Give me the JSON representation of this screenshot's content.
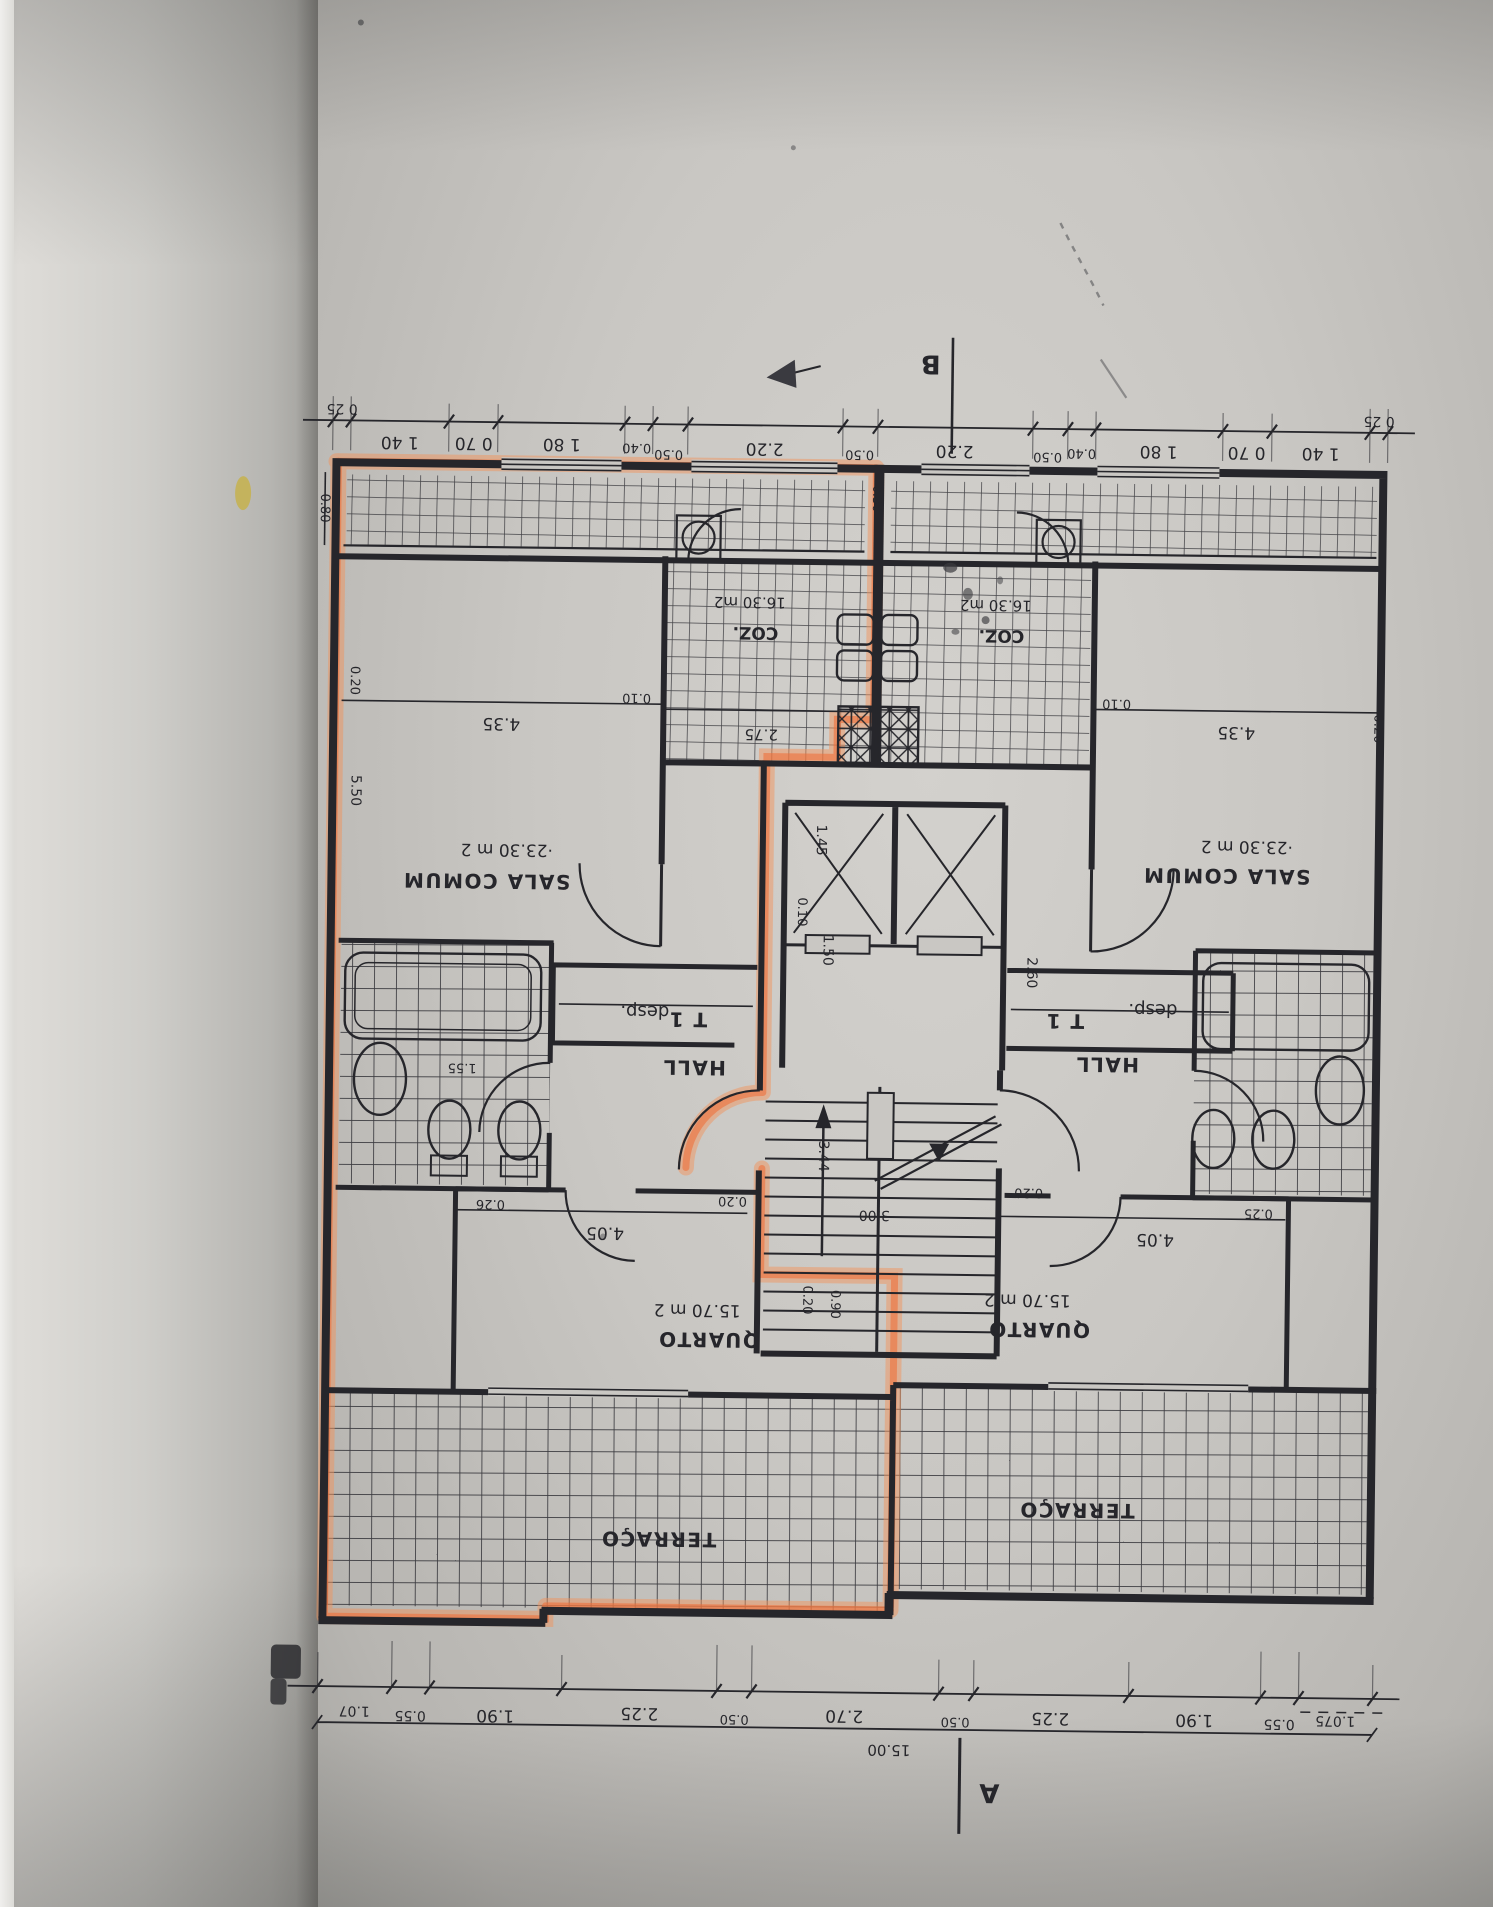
{
  "photo": {
    "description": "scanned floor plan page, plan printed upside-down, one unit traced with orange highlighter",
    "colors": {
      "highlight_orange": "#ee7a3c",
      "paper": "#c9c7c3",
      "ink": "#26262b",
      "stain_yellow": "#c6b14e"
    }
  },
  "markers": {
    "section_top": "B",
    "section_bottom": "A"
  },
  "rooms": {
    "sala": {
      "name": "SALA COMUM",
      "area": "·23.30 m 2"
    },
    "coz": {
      "name": "COZ.",
      "area": "16.30 m2"
    },
    "quarto": {
      "name": "QUARTO",
      "area": "15.70 m 2"
    },
    "terraco": {
      "name": "TERRAÇO"
    },
    "hall": {
      "name": "HALL",
      "type": "T 1"
    },
    "desp": {
      "name": "desp."
    },
    "banho_dim": "1.55"
  },
  "dims": {
    "top": [
      "0 25",
      "1 40",
      "0 70",
      "1 80",
      "0.40",
      "0.50",
      "2.20",
      "0.50",
      "2.20",
      "0.50",
      "0.40",
      "1 80",
      "0 70",
      "1 40",
      "0 25"
    ],
    "bottom": [
      "1.07",
      "0.55",
      "1.90",
      "2.25",
      "0.50",
      "2.70",
      "0.50",
      "2.25",
      "1.90",
      "0.55",
      "1.075"
    ],
    "overall": "15.00",
    "interior": {
      "w435": "4.35",
      "w010": "0.10",
      "w020": "0.20",
      "w550": "5.50",
      "w275": "2.75",
      "w030": "0.30",
      "w145": "1.45",
      "w150": "1.50",
      "w260": "2.60",
      "w344": "3.44",
      "w300": "3.00",
      "w405": "4.05",
      "w026": "0.26",
      "w025": "0.25",
      "w090": "0.90",
      "w080": "0.80"
    }
  }
}
